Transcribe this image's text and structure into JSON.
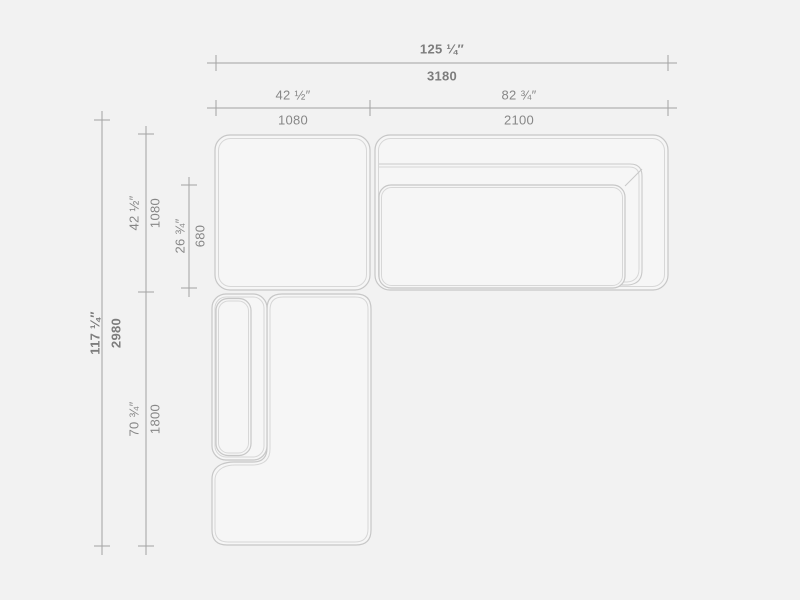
{
  "diagram": {
    "type": "furniture-dimension-drawing",
    "subject": "sectional-sofa-top-view-plan",
    "colors": {
      "background": "#f2f2f2",
      "module_fill": "#f6f6f6",
      "outline": "#c7c7c7",
      "inner_outline": "#d7d7d7",
      "dimension_line": "#a3a3a3",
      "text": "#878787"
    },
    "dimensions": {
      "overall_width": {
        "inches": "125 ¼″",
        "mm": "3180"
      },
      "left_section_width": {
        "inches": "42 ½″",
        "mm": "1080"
      },
      "right_section_width": {
        "inches": "82 ¾″",
        "mm": "2100"
      },
      "overall_depth": {
        "inches": "117 ¼″",
        "mm": "2980"
      },
      "left_section_depth": {
        "inches": "42 ½″",
        "mm": "1080"
      },
      "seat_depth": {
        "inches": "26 ¾″",
        "mm": "680"
      },
      "chaise_section_depth": {
        "inches": "70 ¾″",
        "mm": "1800"
      }
    }
  }
}
